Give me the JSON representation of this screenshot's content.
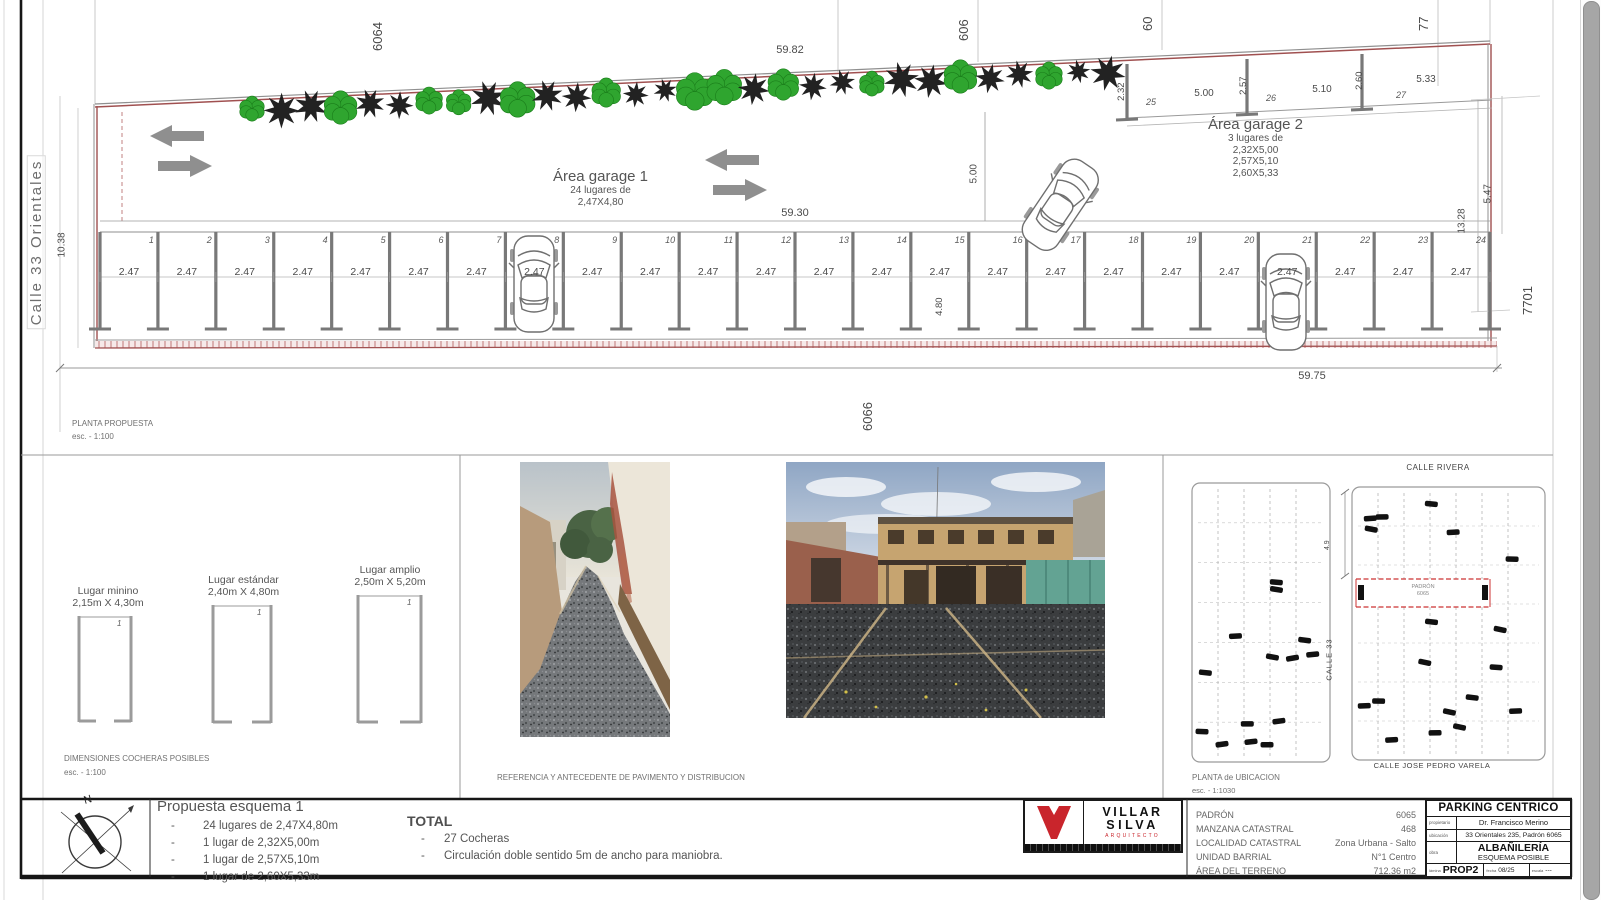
{
  "plan": {
    "street": "Calle 33 Orientales",
    "neighbors": {
      "top_left": "6064",
      "top_mid": "606",
      "top_mid2": "60",
      "top_right": "77",
      "right": "7701",
      "bottom": "6066"
    },
    "dims": {
      "top": "59.82",
      "row": "59.30",
      "bottom": "59.75",
      "left": "10.38",
      "right_a": "13.28",
      "right_b": "5.47",
      "circulation": "5.00",
      "depth": "4.80",
      "stall_width": "2.47",
      "g2_w1": "2.32",
      "g2_l1": "5.00",
      "g2_w2": "2.57",
      "g2_l2": "5.10",
      "g2_w3": "2.60",
      "g2_l3": "5.33"
    },
    "garage1": {
      "title": "Área garage 1",
      "subtitle": "24 lugares de",
      "size": "2,47X4,80"
    },
    "garage2": {
      "title": "Área garage 2",
      "subtitle": "3 lugares de",
      "size1": "2,32X5,00",
      "size2": "2,57X5,10",
      "size3": "2,60X5,33",
      "stall1": "25",
      "stall2": "26",
      "stall3": "27"
    },
    "stalls": [
      "1",
      "2",
      "3",
      "4",
      "5",
      "6",
      "7",
      "8",
      "9",
      "10",
      "11",
      "12",
      "13",
      "14",
      "15",
      "16",
      "17",
      "18",
      "19",
      "20",
      "21",
      "22",
      "23",
      "24"
    ],
    "caption": "PLANTA PROPUESTA",
    "caption_scale": "esc. - 1:100"
  },
  "cocheras": {
    "caption": "DIMENSIONES COCHERAS POSIBLES",
    "caption_scale": "esc. - 1:100",
    "marker": "1",
    "items": [
      {
        "name": "Lugar minino",
        "size": "2,15m X 4,30m"
      },
      {
        "name": "Lugar estándar",
        "size": "2,40m X 4,80m"
      },
      {
        "name": "Lugar amplio",
        "size": "2,50m X 5,20m"
      }
    ]
  },
  "photos": {
    "caption": "REFERENCIA Y ANTECEDENTE DE PAVIMENTO Y DISTRIBUCION"
  },
  "map": {
    "street_top": "CALLE RIVERA",
    "street_left": "CALLE 33",
    "street_bottom": "CALLE JOSE PEDRO VARELA",
    "dim": "4.9",
    "parcel_label": "PADRÓN",
    "parcel_number": "6065",
    "caption": "PLANTA de UBICACION",
    "caption_scale": "esc. - 1:1030"
  },
  "titlebar": {
    "north": "N",
    "proposal": {
      "title": "Propuesta esquema 1",
      "bullet": "-",
      "items": [
        "24 lugares de 2,47X4,80m",
        "1 lugar de 2,32X5,00m",
        "1 lugar de 2,57X5,10m",
        "1 lugar de 2,60X5,33m"
      ]
    },
    "total": {
      "title": "TOTAL",
      "bullet": "-",
      "items": [
        "27 Cocheras",
        "Circulación doble sentido 5m de ancho para maniobra."
      ]
    },
    "logo": {
      "line1": "VILLAR",
      "line2": "SILVA",
      "line3": "ARQUITECTO"
    },
    "cadastral": [
      {
        "label": "PADRÓN",
        "value": "6065"
      },
      {
        "label": "MANZANA CATASTRAL",
        "value": "468"
      },
      {
        "label": "LOCALIDAD CATASTRAL",
        "value": "Zona Urbana - Salto"
      },
      {
        "label": "UNIDAD BARRIAL",
        "value": "N°1 Centro"
      },
      {
        "label": "ÁREA DEL TERRENO",
        "value": "712.36 m2"
      }
    ],
    "titleblock": {
      "project": "PARKING CENTRICO",
      "owner_label": "propietario",
      "owner": "Dr. Francisco Merino",
      "location_label": "ubicación",
      "location": "33 Orientales 235, Padrón 6065",
      "work_label": "obra",
      "work_line1": "ALBAÑILERÍA",
      "work_line2": "ESQUEMA POSIBLE",
      "sheet_label": "lámina",
      "sheet": "PROP2",
      "date_label": "fecha",
      "date": "08/25",
      "scale_label": "escala",
      "scale": "---"
    }
  },
  "colors": {
    "boundary": "#a05050",
    "tree_green": "#2fa52f",
    "tree_dark": "#161616",
    "logo_red": "#c9252c",
    "parcel_red": "#cc3333",
    "divider_gray": "#787878"
  }
}
